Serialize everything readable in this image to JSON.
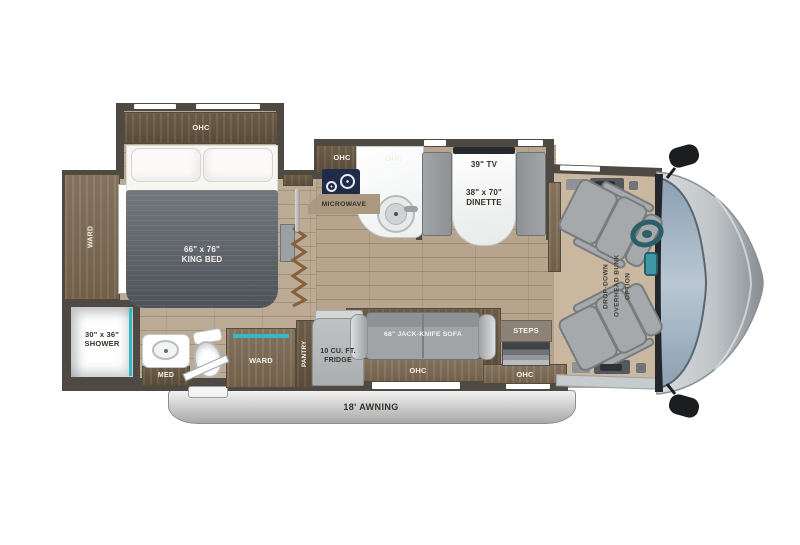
{
  "bedroom": {
    "ohc": "OHC",
    "ward": "WARD",
    "bed": "66\" x 76\"\nKING BED"
  },
  "bathroom": {
    "shower": "30\" x 36\"\nSHOWER",
    "med": "MED"
  },
  "kitchen": {
    "ohc_left": "OHC",
    "ohc_right": "OHC",
    "microwave": "MICROWAVE"
  },
  "dinette": {
    "tv": "39\" TV",
    "table": "38\" x 70\"\nDINETTE"
  },
  "hall": {
    "ward": "WARD",
    "pantry": "PANTRY",
    "fridge": "10 CU. FT.\nFRIDGE"
  },
  "living": {
    "sofa": "68\" JACK-KNIFE SOFA",
    "ohc": "OHC"
  },
  "entry": {
    "steps": "STEPS",
    "ohc": "OHC"
  },
  "cab": {
    "bunk_option": "DROP-DOWN\nOVERHEAD BUNK\nOPTION"
  },
  "exterior": {
    "awning": "18' AWNING"
  },
  "colors": {
    "accent_teal": "#35b8c6",
    "wood": "#7c6b56",
    "wall": "#4f4943",
    "floor": "#b6a48c",
    "windshield_glass": "#9db0c0",
    "cooktop_navy": "#1f2b49",
    "awning_gray": "#c6c6c6"
  }
}
